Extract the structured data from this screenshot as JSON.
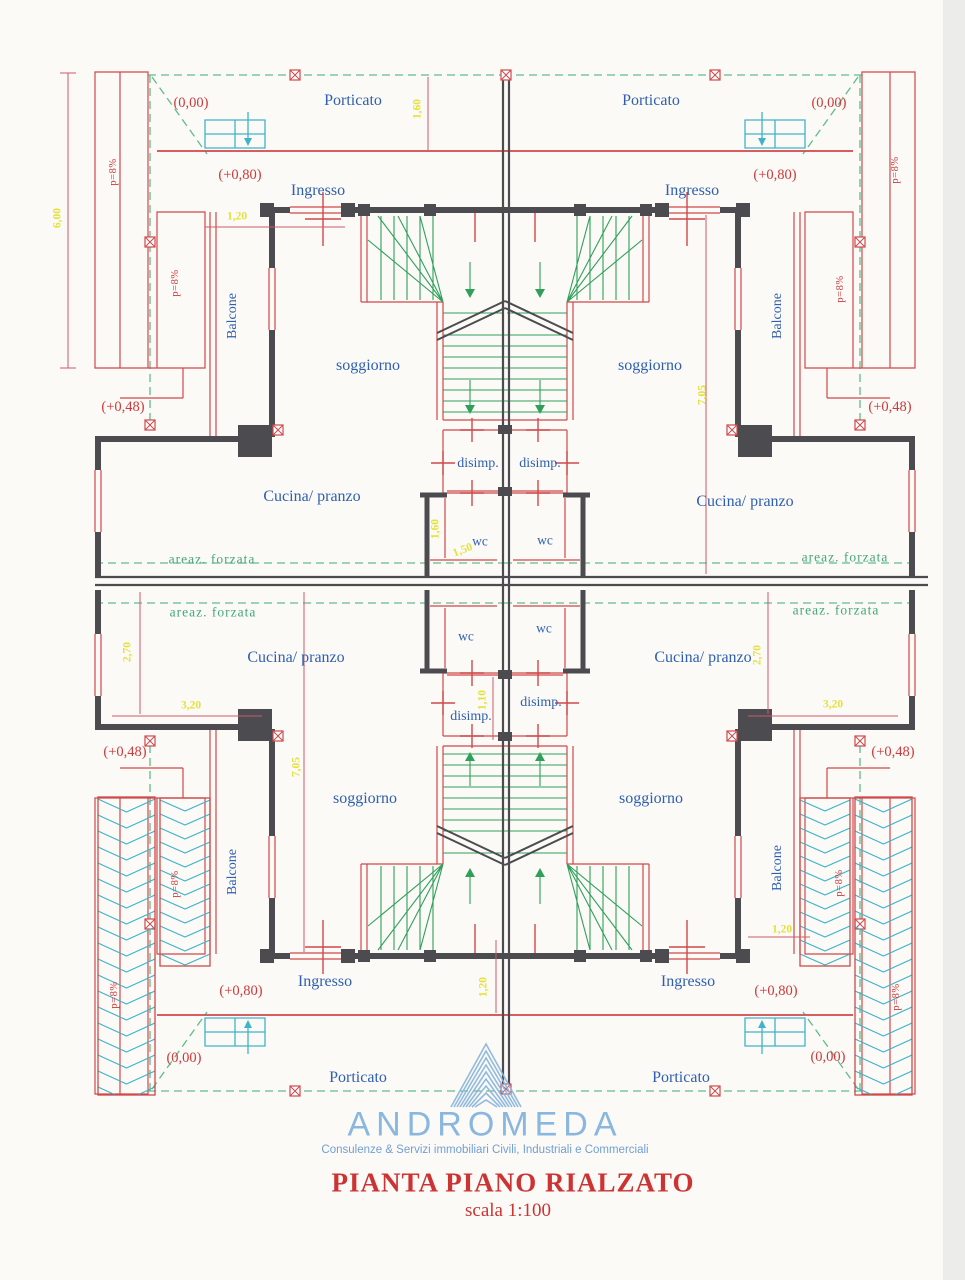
{
  "rooms": {
    "porticato": "Porticato",
    "ingresso": "Ingresso",
    "soggiorno": "soggiorno",
    "cucina": "Cucina/ pranzo",
    "wc": "wc",
    "disimp": "disimp.",
    "balcone": "Balcone",
    "areaz": "areaz. forzata"
  },
  "levels": {
    "ground": "(0,00)",
    "entry": "(+0,80)",
    "terrace": "(+0,48)"
  },
  "slope": "p=8%",
  "dims": {
    "d600": "6,00",
    "d160": "1,60",
    "d120": "1,20",
    "d705": "7,05",
    "d150": "1,50",
    "d110": "1,10",
    "d270": "2,70",
    "d320": "3,20"
  },
  "logo": {
    "name": "ANDROMEDA",
    "tagline": "Consulenze & Servizi immobiliari Civili, Industriali e Commerciali"
  },
  "title": {
    "text": "PIANTA PIANO RIALZATO",
    "scale": "scala 1:100"
  },
  "colors": {
    "wall_dark": "#4c4c50",
    "wall_red": "#d0484a",
    "dim_line": "#cd5a6a",
    "boundary_green": "#5fbd8c",
    "stair_green": "#2fa05a",
    "steps_cyan": "#3fb3c9",
    "room_text_blue": "#2f5fae",
    "dim_text_yellow": "#e3e23c",
    "level_text_red": "#cc3a3a",
    "logo_blue": "#85b4de",
    "title_red": "#cc3333"
  }
}
